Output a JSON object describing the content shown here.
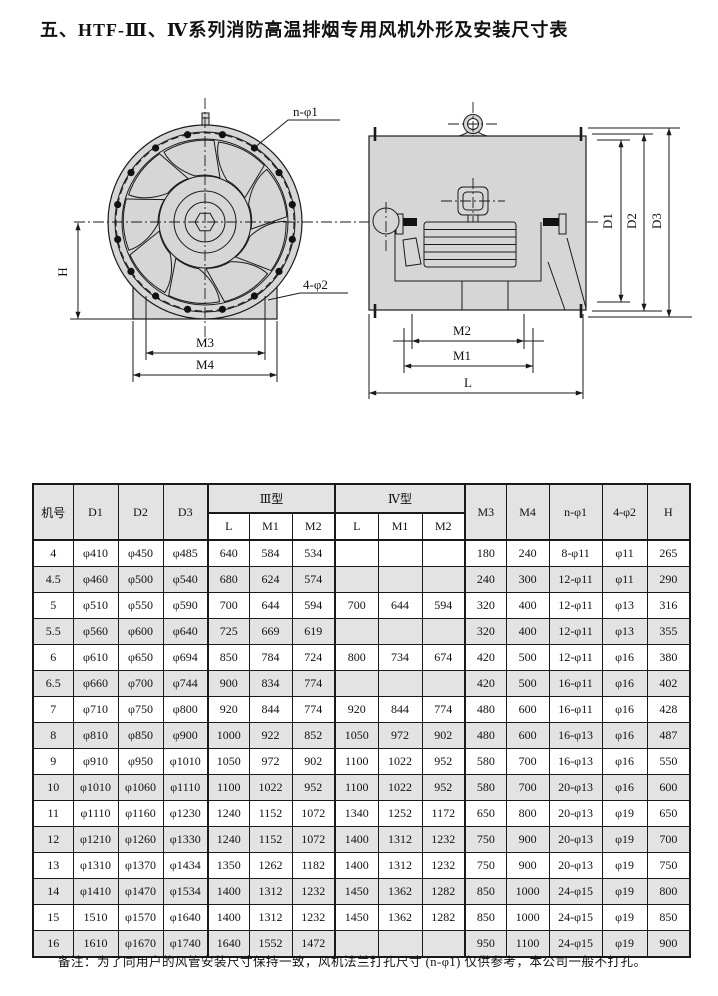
{
  "page": {
    "title": "五、HTF-Ⅲ、Ⅳ系列消防高温排烟专用风机外形及安装尺寸表",
    "note": "备注：为了同用户的风管安装尺寸保持一致，风机法兰打孔尺寸 (n-φ1) 仅供参考，本公司一般不打孔。"
  },
  "colors": {
    "background": "#ffffff",
    "drawing_fill": "#d6d6d6",
    "table_shade": "#e3e3e3",
    "line": "#1a1a1a"
  },
  "drawing": {
    "front_view": {
      "labels": {
        "n_phi1": "n-φ1",
        "four_phi2": "4-φ2",
        "h": "H",
        "m3": "M3",
        "m4": "M4"
      }
    },
    "side_view": {
      "labels": {
        "d1": "D1",
        "d2": "D2",
        "d3": "D3",
        "m2": "M2",
        "m1": "M1",
        "l": "L"
      }
    }
  },
  "table": {
    "header": {
      "machine_no": "机号",
      "d1": "D1",
      "d2": "D2",
      "d3": "D3",
      "type3": "Ⅲ型",
      "type4": "Ⅳ型",
      "sub": [
        "L",
        "M1",
        "M2",
        "L",
        "M1",
        "M2"
      ],
      "m3": "M3",
      "m4": "M4",
      "n_phi1": "n-φ1",
      "four_phi2": "4-φ2",
      "h": "H"
    },
    "rows": [
      [
        "4",
        "φ410",
        "φ450",
        "φ485",
        "640",
        "584",
        "534",
        "",
        "",
        "",
        "180",
        "240",
        "8-φ11",
        "φ11",
        "265"
      ],
      [
        "4.5",
        "φ460",
        "φ500",
        "φ540",
        "680",
        "624",
        "574",
        "",
        "",
        "",
        "240",
        "300",
        "12-φ11",
        "φ11",
        "290"
      ],
      [
        "5",
        "φ510",
        "φ550",
        "φ590",
        "700",
        "644",
        "594",
        "700",
        "644",
        "594",
        "320",
        "400",
        "12-φ11",
        "φ13",
        "316"
      ],
      [
        "5.5",
        "φ560",
        "φ600",
        "φ640",
        "725",
        "669",
        "619",
        "",
        "",
        "",
        "320",
        "400",
        "12-φ11",
        "φ13",
        "355"
      ],
      [
        "6",
        "φ610",
        "φ650",
        "φ694",
        "850",
        "784",
        "724",
        "800",
        "734",
        "674",
        "420",
        "500",
        "12-φ11",
        "φ16",
        "380"
      ],
      [
        "6.5",
        "φ660",
        "φ700",
        "φ744",
        "900",
        "834",
        "774",
        "",
        "",
        "",
        "420",
        "500",
        "16-φ11",
        "φ16",
        "402"
      ],
      [
        "7",
        "φ710",
        "φ750",
        "φ800",
        "920",
        "844",
        "774",
        "920",
        "844",
        "774",
        "480",
        "600",
        "16-φ11",
        "φ16",
        "428"
      ],
      [
        "8",
        "φ810",
        "φ850",
        "φ900",
        "1000",
        "922",
        "852",
        "1050",
        "972",
        "902",
        "480",
        "600",
        "16-φ13",
        "φ16",
        "487"
      ],
      [
        "9",
        "φ910",
        "φ950",
        "φ1010",
        "1050",
        "972",
        "902",
        "1100",
        "1022",
        "952",
        "580",
        "700",
        "16-φ13",
        "φ16",
        "550"
      ],
      [
        "10",
        "φ1010",
        "φ1060",
        "φ1110",
        "1100",
        "1022",
        "952",
        "1100",
        "1022",
        "952",
        "580",
        "700",
        "20-φ13",
        "φ16",
        "600"
      ],
      [
        "11",
        "φ1110",
        "φ1160",
        "φ1230",
        "1240",
        "1152",
        "1072",
        "1340",
        "1252",
        "1172",
        "650",
        "800",
        "20-φ13",
        "φ19",
        "650"
      ],
      [
        "12",
        "φ1210",
        "φ1260",
        "φ1330",
        "1240",
        "1152",
        "1072",
        "1400",
        "1312",
        "1232",
        "750",
        "900",
        "20-φ13",
        "φ19",
        "700"
      ],
      [
        "13",
        "φ1310",
        "φ1370",
        "φ1434",
        "1350",
        "1262",
        "1182",
        "1400",
        "1312",
        "1232",
        "750",
        "900",
        "20-φ13",
        "φ19",
        "750"
      ],
      [
        "14",
        "φ1410",
        "φ1470",
        "φ1534",
        "1400",
        "1312",
        "1232",
        "1450",
        "1362",
        "1282",
        "850",
        "1000",
        "24-φ15",
        "φ19",
        "800"
      ],
      [
        "15",
        "1510",
        "φ1570",
        "φ1640",
        "1400",
        "1312",
        "1232",
        "1450",
        "1362",
        "1282",
        "850",
        "1000",
        "24-φ15",
        "φ19",
        "850"
      ],
      [
        "16",
        "1610",
        "φ1670",
        "φ1740",
        "1640",
        "1552",
        "1472",
        "",
        "",
        "",
        "950",
        "1100",
        "24-φ15",
        "φ19",
        "900"
      ]
    ]
  }
}
